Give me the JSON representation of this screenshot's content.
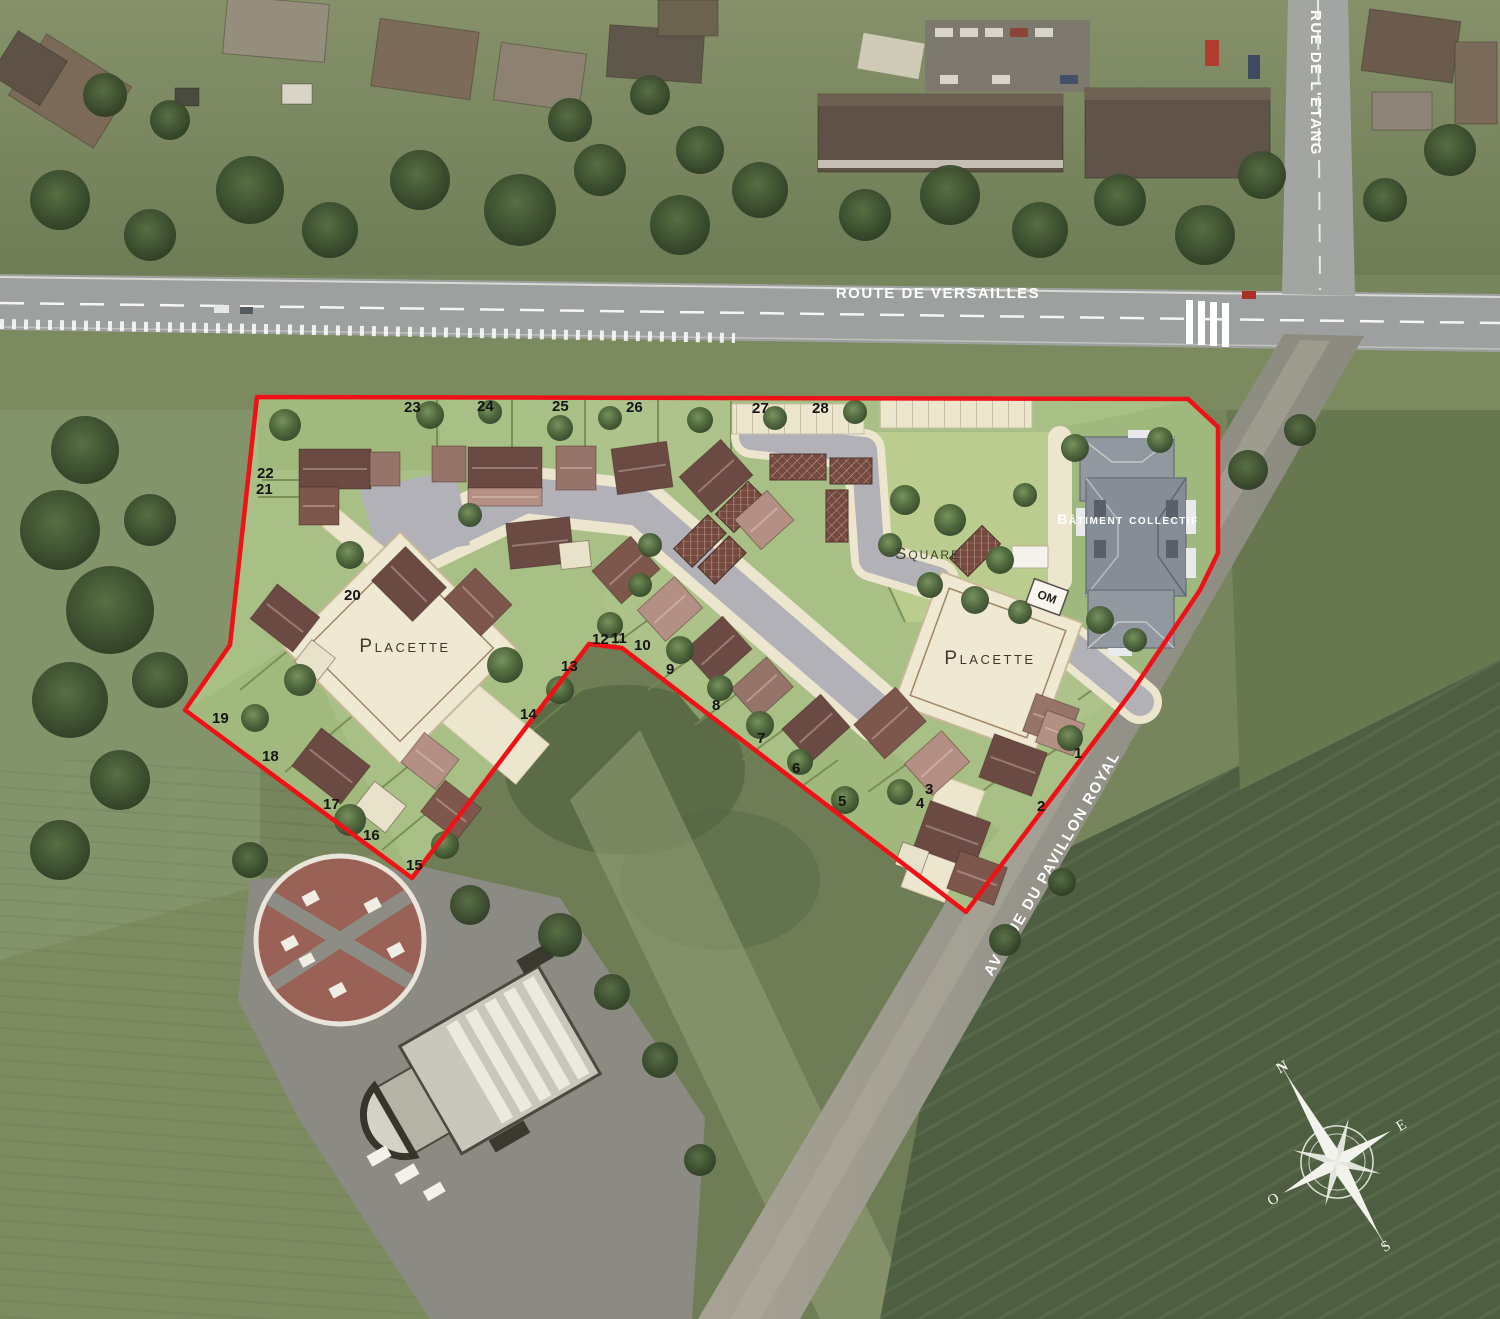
{
  "roads": {
    "route_de_versailles": "ROUTE DE VERSAILLES",
    "rue_de_letang": "RUE DE L'ETANG",
    "avenue_du_pavillon_royal": "AVENUE DU PAVILLON ROYAL"
  },
  "site": {
    "placette_west": "Placette",
    "placette_east": "Placette",
    "square": "Square",
    "batiment_collectif": "Bâtiment collectif",
    "om_label": "OM",
    "boundary_color": "#ee1217",
    "lot_numbers": [
      {
        "n": "1",
        "x": 1074,
        "y": 758
      },
      {
        "n": "2",
        "x": 1037,
        "y": 811
      },
      {
        "n": "3",
        "x": 925,
        "y": 794
      },
      {
        "n": "4",
        "x": 916,
        "y": 808
      },
      {
        "n": "5",
        "x": 838,
        "y": 806
      },
      {
        "n": "6",
        "x": 792,
        "y": 773
      },
      {
        "n": "7",
        "x": 757,
        "y": 743
      },
      {
        "n": "8",
        "x": 712,
        "y": 710
      },
      {
        "n": "9",
        "x": 666,
        "y": 674
      },
      {
        "n": "10",
        "x": 634,
        "y": 650
      },
      {
        "n": "11",
        "x": 611,
        "y": 643
      },
      {
        "n": "12",
        "x": 592,
        "y": 644
      },
      {
        "n": "13",
        "x": 561,
        "y": 671
      },
      {
        "n": "14",
        "x": 520,
        "y": 719
      },
      {
        "n": "15",
        "x": 406,
        "y": 870
      },
      {
        "n": "16",
        "x": 363,
        "y": 840
      },
      {
        "n": "17",
        "x": 323,
        "y": 809
      },
      {
        "n": "18",
        "x": 262,
        "y": 761
      },
      {
        "n": "19",
        "x": 212,
        "y": 723
      },
      {
        "n": "20",
        "x": 344,
        "y": 600
      },
      {
        "n": "21",
        "x": 256,
        "y": 494
      },
      {
        "n": "22",
        "x": 257,
        "y": 478
      },
      {
        "n": "23",
        "x": 404,
        "y": 412
      },
      {
        "n": "24",
        "x": 477,
        "y": 411
      },
      {
        "n": "25",
        "x": 552,
        "y": 411
      },
      {
        "n": "26",
        "x": 626,
        "y": 412
      },
      {
        "n": "27",
        "x": 752,
        "y": 413
      },
      {
        "n": "28",
        "x": 812,
        "y": 413
      }
    ]
  },
  "compass": {
    "north": "N",
    "east": "E",
    "south": "S",
    "west": "O"
  }
}
